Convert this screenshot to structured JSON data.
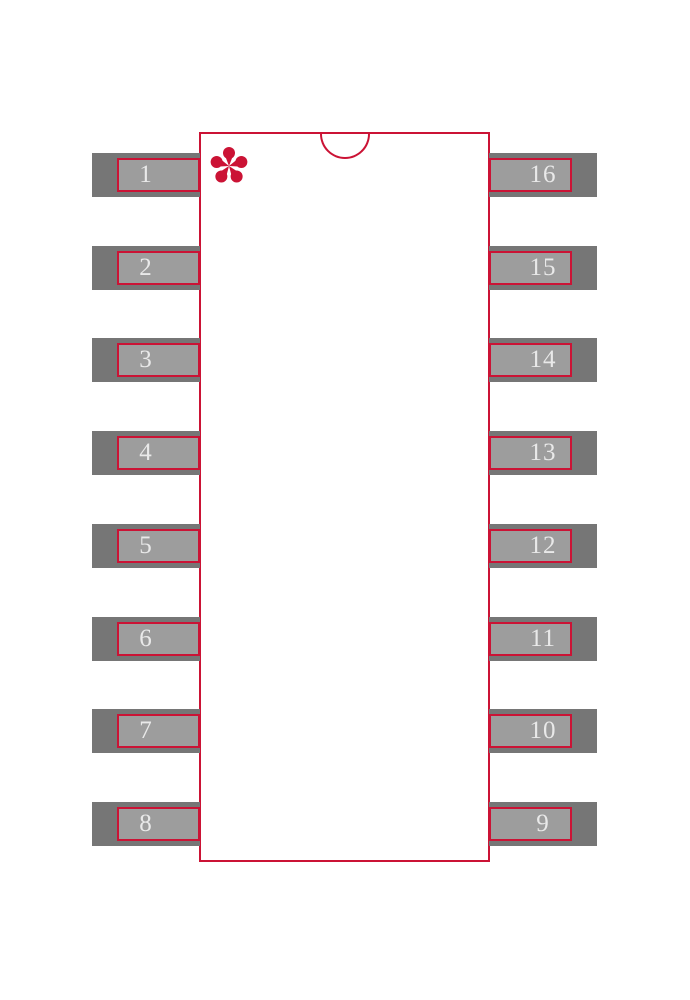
{
  "footprint": {
    "colors": {
      "outline_red": "#cb1335",
      "pad_outer_gray": "#767676",
      "pad_inner_gray": "#9d9d9d",
      "pin_number_text": "#e9e9e9",
      "background": "#ffffff"
    },
    "pin1_marker_icon": "asterisk",
    "pins": {
      "left": [
        {
          "number": "1"
        },
        {
          "number": "2"
        },
        {
          "number": "3"
        },
        {
          "number": "4"
        },
        {
          "number": "5"
        },
        {
          "number": "6"
        },
        {
          "number": "7"
        },
        {
          "number": "8"
        }
      ],
      "right": [
        {
          "number": "16"
        },
        {
          "number": "15"
        },
        {
          "number": "14"
        },
        {
          "number": "13"
        },
        {
          "number": "12"
        },
        {
          "number": "11"
        },
        {
          "number": "10"
        },
        {
          "number": "9"
        }
      ]
    }
  }
}
